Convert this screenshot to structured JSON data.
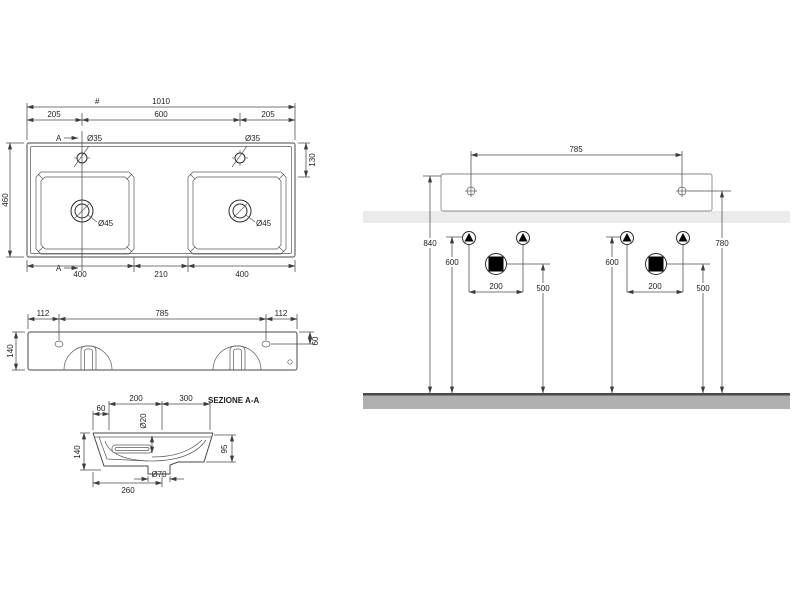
{
  "drawing": {
    "plan": {
      "ref_mark": "#",
      "overall_width": "1010",
      "dim_side": "205",
      "dim_center": "600",
      "section_letter": "A",
      "faucet_hole_dia": "Ø35",
      "deck_depth": "130",
      "overall_depth": "460",
      "drain_dia": "Ø45",
      "basin_width": "400",
      "basin_gap": "210"
    },
    "front": {
      "dim_side": "112",
      "hole_spacing": "785",
      "height": "140",
      "hole_drop": "60"
    },
    "section": {
      "title": "SEZIONE A-A",
      "dim_60": "60",
      "dim_200": "200",
      "dim_300": "300",
      "overflow_dia": "Ø20",
      "height": "140",
      "bowl_depth": "95",
      "base_width": "260",
      "drain_dia": "Ø70"
    },
    "installation": {
      "fixing_spacing": "785",
      "total_height": "840",
      "supply_height": "600",
      "supply_spacing": "200",
      "drain_height": "500",
      "fixing_height": "780"
    }
  },
  "colors": {
    "wall_band": "#ebebeb",
    "floor_fill": "#b0b0b0",
    "floor_edge": "#4a4a4a",
    "symbol_fill": "#000000"
  }
}
